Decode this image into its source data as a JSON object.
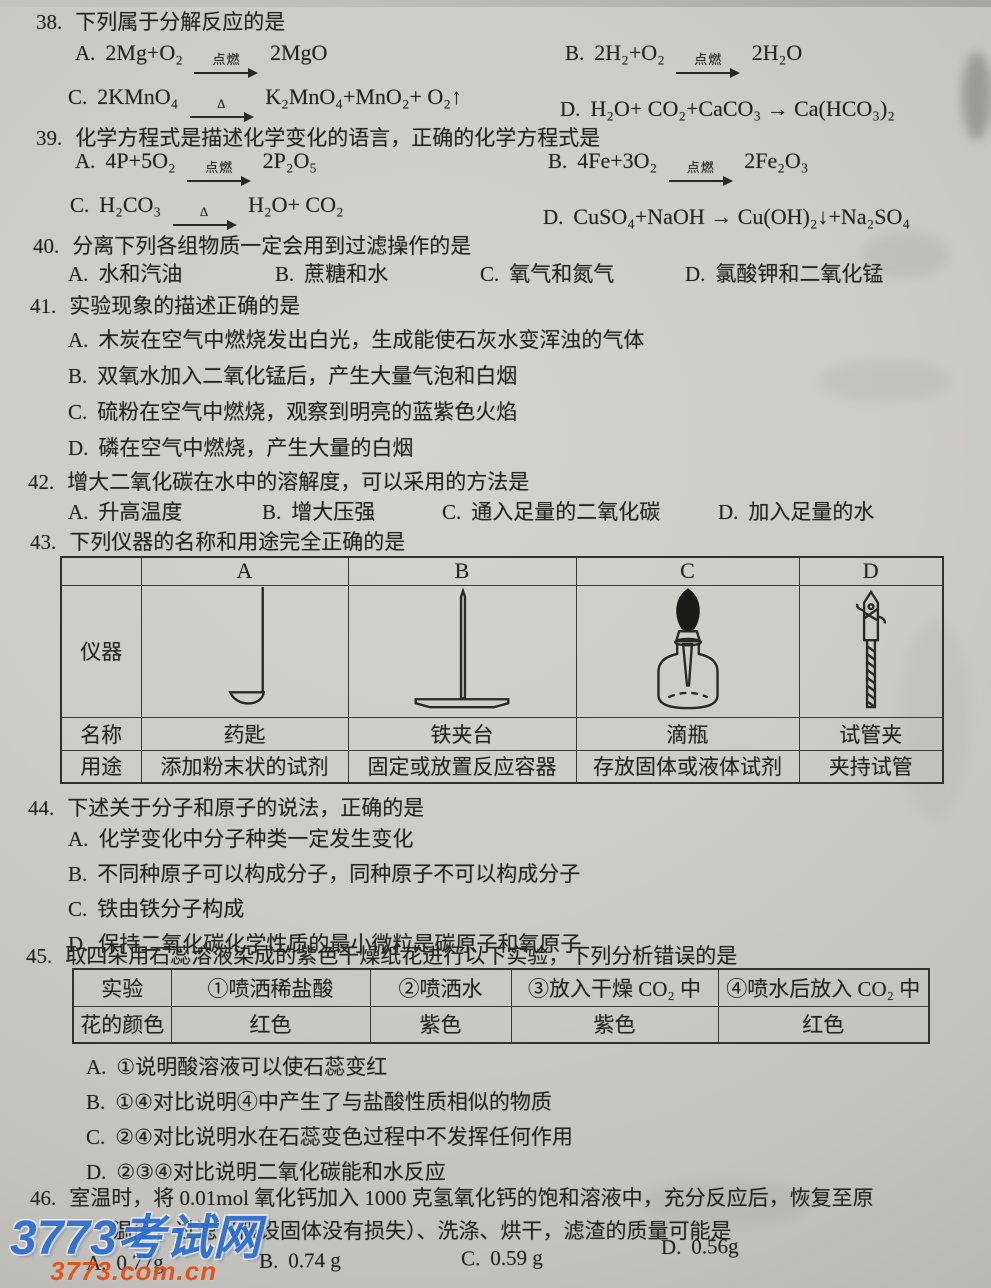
{
  "q38": {
    "number": "38.",
    "title": "下列属于分解反应的是",
    "options": [
      {
        "label": "A.",
        "eq": "2Mg+O₂ →[点燃] 2MgO"
      },
      {
        "label": "B.",
        "eq": "2H₂+O₂ →[点燃] 2H₂O"
      },
      {
        "label": "C.",
        "eq": "2KMnO₄ →[Δ] K₂MnO₄+MnO₂+ O₂↑"
      },
      {
        "label": "D.",
        "eq": "H₂O+ CO₂+CaCO₃ → Ca(HCO₃)₂"
      }
    ]
  },
  "q39": {
    "number": "39.",
    "title": "化学方程式是描述化学变化的语言，正确的化学方程式是",
    "options": [
      {
        "label": "A.",
        "eq": "4P+5O₂ →[点燃] 2P₂O₅"
      },
      {
        "label": "B.",
        "eq": "4Fe+3O₂ →[点燃] 2Fe₂O₃"
      },
      {
        "label": "C.",
        "eq": "H₂CO₃ →[Δ] H₂O+ CO₂"
      },
      {
        "label": "D.",
        "eq": "CuSO₄+NaOH → Cu(OH)₂↓+Na₂SO₄"
      }
    ]
  },
  "q40": {
    "number": "40.",
    "title": "分离下列各组物质一定会用到过滤操作的是",
    "options": [
      {
        "label": "A.",
        "text": "水和汽油"
      },
      {
        "label": "B.",
        "text": "蔗糖和水"
      },
      {
        "label": "C.",
        "text": "氧气和氮气"
      },
      {
        "label": "D.",
        "text": "氯酸钾和二氧化锰"
      }
    ]
  },
  "q41": {
    "number": "41.",
    "title": "实验现象的描述正确的是",
    "options": [
      {
        "label": "A.",
        "text": "木炭在空气中燃烧发出白光，生成能使石灰水变浑浊的气体"
      },
      {
        "label": "B.",
        "text": "双氧水加入二氧化锰后，产生大量气泡和白烟"
      },
      {
        "label": "C.",
        "text": "硫粉在空气中燃烧，观察到明亮的蓝紫色火焰"
      },
      {
        "label": "D.",
        "text": "磷在空气中燃烧，产生大量的白烟"
      }
    ]
  },
  "q42": {
    "number": "42.",
    "title": "增大二氧化碳在水中的溶解度，可以采用的方法是",
    "options": [
      {
        "label": "A.",
        "text": "升高温度"
      },
      {
        "label": "B.",
        "text": "增大压强"
      },
      {
        "label": "C.",
        "text": "通入足量的二氧化碳"
      },
      {
        "label": "D.",
        "text": "加入足量的水"
      }
    ]
  },
  "q43": {
    "number": "43.",
    "title": "下列仪器的名称和用途完全正确的是",
    "table": {
      "col_headers": [
        "A",
        "B",
        "C",
        "D"
      ],
      "row_labels": [
        "仪器",
        "名称",
        "用途"
      ],
      "instruments": [
        "medicine-spoon",
        "iron-stand",
        "dropper-bottle",
        "test-tube-clamp"
      ],
      "names": [
        "药匙",
        "铁夹台",
        "滴瓶",
        "试管夹"
      ],
      "uses": [
        "添加粉末状的试剂",
        "固定或放置反应容器",
        "存放固体或液体试剂",
        "夹持试管"
      ]
    }
  },
  "q44": {
    "number": "44.",
    "title": "下述关于分子和原子的说法，正确的是",
    "options": [
      {
        "label": "A.",
        "text": "化学变化中分子种类一定发生变化"
      },
      {
        "label": "B.",
        "text": "不同种原子可以构成分子，同种原子不可以构成分子"
      },
      {
        "label": "C.",
        "text": "铁由铁分子构成"
      },
      {
        "label": "D.",
        "text": "保持二氧化碳化学性质的最小微粒是碳原子和氧原子"
      }
    ]
  },
  "q45": {
    "number": "45.",
    "title": "取四朵用石蕊溶液染成的紫色干燥纸花进行以下实验，下列分析错误的是",
    "table": {
      "row1_label": "实验",
      "experiments": [
        "①喷洒稀盐酸",
        "②喷洒水",
        "③放入干燥 CO₂ 中",
        "④喷水后放入 CO₂ 中"
      ],
      "row2_label": "花的颜色",
      "flower_colors": [
        "红色",
        "紫色",
        "紫色",
        "红色"
      ]
    },
    "options": [
      {
        "label": "A.",
        "text": "①说明酸溶液可以使石蕊变红"
      },
      {
        "label": "B.",
        "text": "①④对比说明④中产生了与盐酸性质相似的物质"
      },
      {
        "label": "C.",
        "text": "②④对比说明水在石蕊变色过程中不发挥任何作用"
      },
      {
        "label": "D.",
        "text": "②③④对比说明二氧化碳能和水反应"
      }
    ]
  },
  "q46": {
    "number": "46.",
    "line1": "室温时，将 0.01mol 氧化钙加入 1000 克氢氧化钙的饱和溶液中，充分反应后，恢复至原",
    "line2": "温度，过滤（假设固体没有损失）、洗涤、烘干，滤渣的质量可能是",
    "options": [
      {
        "label": "A.",
        "text": "0.77g"
      },
      {
        "label": "B.",
        "text": "0.74 g"
      },
      {
        "label": "C.",
        "text": "0.59 g"
      },
      {
        "label": "D.",
        "text": "0.56g"
      }
    ]
  },
  "watermark": {
    "line1": "3773考试网",
    "line2": "3773.com.cn",
    "blue": "#2b6dd4",
    "orange": "#e84d12"
  }
}
